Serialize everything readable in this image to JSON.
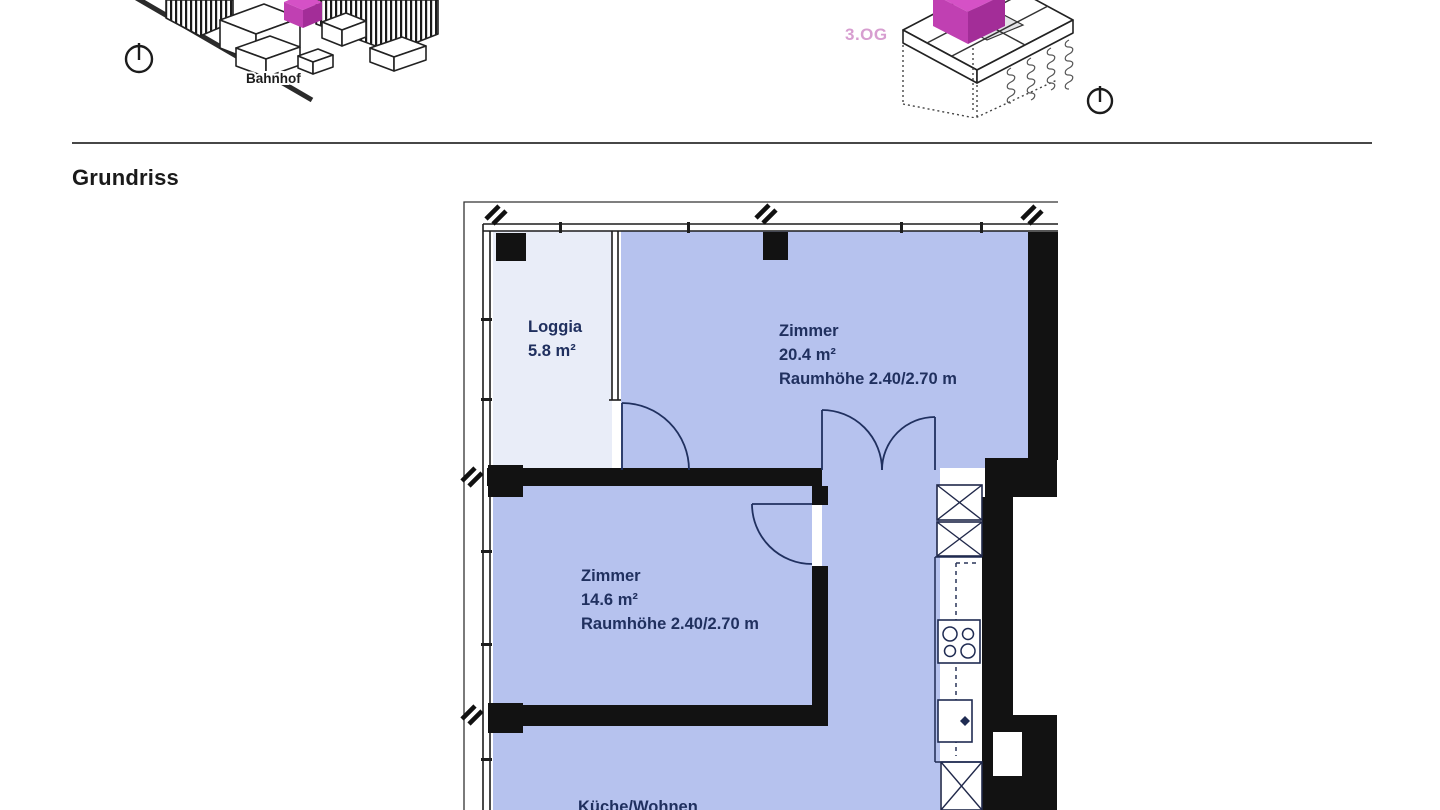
{
  "section": {
    "title": "Grundriss"
  },
  "vignettes": {
    "site": {
      "label": "Bahnhof"
    },
    "floor": {
      "label": "3.OG"
    }
  },
  "floorplan": {
    "rooms": [
      {
        "name": "Loggia",
        "area": "5.8 m²",
        "height": ""
      },
      {
        "name": "Zimmer",
        "area": "20.4 m²",
        "height": "Raumhöhe 2.40/2.70 m"
      },
      {
        "name": "Zimmer",
        "area": "14.6 m²",
        "height": "Raumhöhe 2.40/2.70 m"
      },
      {
        "name": "Küche/Wohnen",
        "area": "",
        "height": ""
      }
    ],
    "colors": {
      "room_fill": "#b6c2ee",
      "loggia_fill": "#e9edf8",
      "wall": "#121212",
      "label": "#20305f",
      "accent_magenta": "#c040b2",
      "accent_magenta_dark": "#a32d98",
      "accent_magenta_light": "#d551c6",
      "floor_label_pink": "#d79ed0"
    }
  }
}
